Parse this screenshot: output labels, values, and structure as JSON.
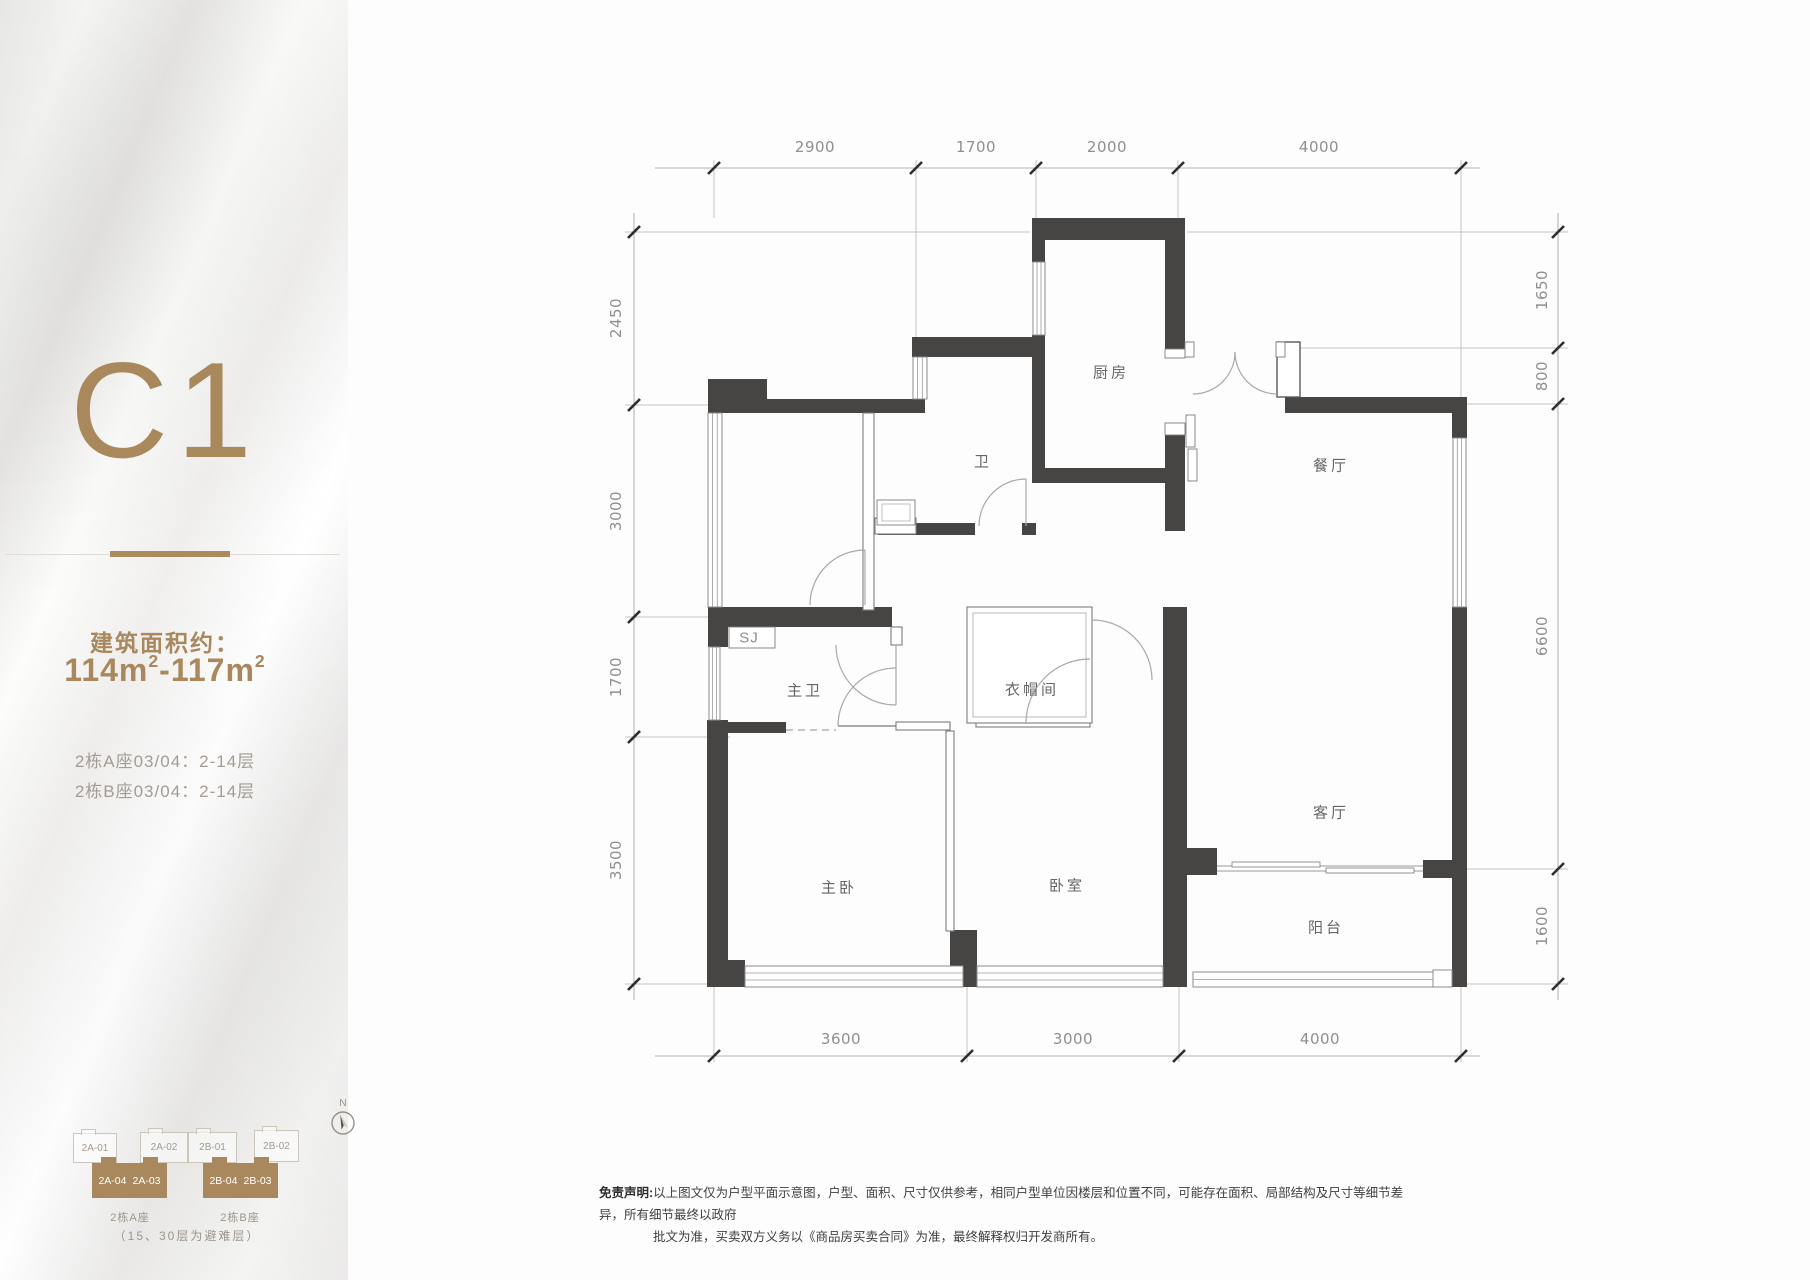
{
  "panel": {
    "plan_code": "C1",
    "area_label": "建筑面积约：",
    "area_v1": "114m",
    "area_sup": "2",
    "area_v2": "-117m",
    "floors": [
      "2栋A座03/04：2-14层",
      "2栋B座03/04：2-14层"
    ]
  },
  "rooms": {
    "kitchen": "厨房",
    "dining": "餐厅",
    "bath": "卫",
    "shaft": "SJ",
    "master_bath": "主卫",
    "cloak": "衣帽间",
    "living": "客厅",
    "master_bed": "主卧",
    "bedroom": "卧室",
    "balcony": "阳台"
  },
  "dims": {
    "top": [
      "2900",
      "1700",
      "2000",
      "4000"
    ],
    "left": [
      "2450",
      "3000",
      "1700",
      "3500"
    ],
    "right": [
      "1650",
      "800",
      "6600",
      "1600"
    ],
    "bottom": [
      "3600",
      "3000",
      "4000"
    ]
  },
  "key": {
    "north_label": "N",
    "outline_units": [
      {
        "label": "2A-01"
      },
      {
        "label": "2A-02"
      },
      {
        "label": "2B-01"
      },
      {
        "label": "2B-02"
      }
    ],
    "filled_units": [
      {
        "left": "2A-04",
        "right": "2A-03"
      },
      {
        "left": "2B-04",
        "right": "2B-03"
      }
    ],
    "captions": [
      "2栋A座",
      "2栋B座"
    ],
    "note": "（15、30层为避难层）"
  },
  "disclaimer": {
    "prefix": "免责声明:",
    "line1": "以上图文仅为户型平面示意图，户型、面积、尺寸仅供参考，相同户型单位因楼层和位置不同，可能存在面积、局部结构及尺寸等细节差异，所有细节最终以政府",
    "line2": "批文为准，买卖双方义务以《商品房买卖合同》为准，最终解释权归开发商所有。"
  },
  "colors": {
    "gold": "#a8885c",
    "wall": "#474544",
    "dim_text": "#8f8f8f"
  }
}
